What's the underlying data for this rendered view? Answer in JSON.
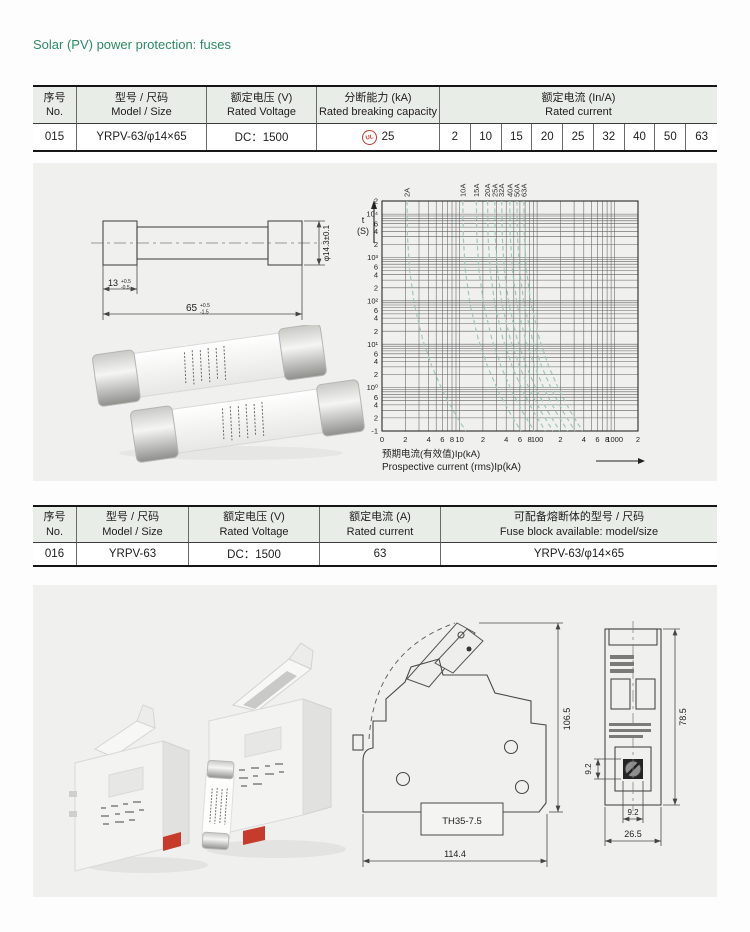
{
  "page": {
    "title": "Solar (PV) power protection: fuses"
  },
  "table1": {
    "headers": {
      "no_zh": "序号",
      "no_en": "No.",
      "model_zh": "型号 / 尺码",
      "model_en": "Model / Size",
      "voltage_zh": "额定电压 (V)",
      "voltage_en": "Rated Voltage",
      "breaking_zh": "分断能力 (kA)",
      "breaking_en": "Rated breaking capacity",
      "current_zh": "额定电流 (In/A)",
      "current_en": "Rated current"
    },
    "row": {
      "no": "015",
      "model": "YRPV-63/φ14×65",
      "voltage": "DC：1500",
      "breaking_mark": "UL",
      "breaking_value": "25",
      "currents": [
        "2",
        "10",
        "15",
        "20",
        "25",
        "32",
        "40",
        "50",
        "63"
      ]
    }
  },
  "fuse_drawing": {
    "dim_cap": "13",
    "dim_cap_tol_top": "+0.5",
    "dim_cap_tol_bottom": "-0.5",
    "dim_length": "65",
    "dim_length_tol_top": "+0.5",
    "dim_length_tol_bottom": "-1.5",
    "dim_diameter": "φ14.3±0.1"
  },
  "chart_data": {
    "type": "line",
    "title": "",
    "x_scale": "log",
    "y_scale": "log",
    "xlim": [
      1,
      2000
    ],
    "ylim": [
      0.1,
      20000
    ],
    "xlabel_zh": "预期电流(有效值)Ip(kA)",
    "xlabel_en": "Prospective current (rms)Ip(kA)",
    "ylabel_line1": "t",
    "ylabel_line2": "(S)",
    "grid": true,
    "legend_position": "top-rotated-labels",
    "curve_color": "#9ec9ba",
    "x_ticks": [
      {
        "v": 1,
        "label": "0"
      },
      {
        "v": 2,
        "label": "2"
      },
      {
        "v": 4,
        "label": "4"
      },
      {
        "v": 6,
        "label": "6"
      },
      {
        "v": 8,
        "label": "8"
      },
      {
        "v": 10,
        "label": "10"
      },
      {
        "v": 20,
        "label": "2"
      },
      {
        "v": 40,
        "label": "4"
      },
      {
        "v": 60,
        "label": "6"
      },
      {
        "v": 80,
        "label": "8"
      },
      {
        "v": 100,
        "label": "100"
      },
      {
        "v": 200,
        "label": "2"
      },
      {
        "v": 400,
        "label": "4"
      },
      {
        "v": 600,
        "label": "6"
      },
      {
        "v": 800,
        "label": "8"
      },
      {
        "v": 1000,
        "label": "1000"
      },
      {
        "v": 2000,
        "label": "2"
      }
    ],
    "y_ticks": [
      {
        "v": 20000,
        "label": "2"
      },
      {
        "v": 10000,
        "label": "10⁴"
      },
      {
        "v": 6000,
        "label": "6"
      },
      {
        "v": 4000,
        "label": "4"
      },
      {
        "v": 2000,
        "label": "2"
      },
      {
        "v": 1000,
        "label": "10³"
      },
      {
        "v": 600,
        "label": "6"
      },
      {
        "v": 400,
        "label": "4"
      },
      {
        "v": 200,
        "label": "2"
      },
      {
        "v": 100,
        "label": "10²"
      },
      {
        "v": 60,
        "label": "6"
      },
      {
        "v": 40,
        "label": "4"
      },
      {
        "v": 20,
        "label": "2"
      },
      {
        "v": 10,
        "label": "10¹"
      },
      {
        "v": 6,
        "label": "6"
      },
      {
        "v": 4,
        "label": "4"
      },
      {
        "v": 2,
        "label": "2"
      },
      {
        "v": 1,
        "label": "10⁰"
      },
      {
        "v": 0.6,
        "label": "6"
      },
      {
        "v": 0.4,
        "label": "4"
      },
      {
        "v": 0.2,
        "label": "2"
      },
      {
        "v": 0.1,
        "label": "-1"
      }
    ],
    "series": [
      {
        "name": "2A",
        "x_at_top": 2.1,
        "x_at_bottom": 12
      },
      {
        "name": "10A",
        "x_at_top": 11,
        "x_at_bottom": 62
      },
      {
        "name": "15A",
        "x_at_top": 16.5,
        "x_at_bottom": 92
      },
      {
        "name": "20A",
        "x_at_top": 23,
        "x_at_bottom": 128
      },
      {
        "name": "25A",
        "x_at_top": 28.5,
        "x_at_bottom": 160
      },
      {
        "name": "32A",
        "x_at_top": 35,
        "x_at_bottom": 196
      },
      {
        "name": "40A",
        "x_at_top": 44.5,
        "x_at_bottom": 248
      },
      {
        "name": "50A",
        "x_at_top": 55,
        "x_at_bottom": 308
      },
      {
        "name": "63A",
        "x_at_top": 67.5,
        "x_at_bottom": 385
      }
    ]
  },
  "table2": {
    "headers": {
      "no_zh": "序号",
      "no_en": "No.",
      "model_zh": "型号 / 尺码",
      "model_en": "Model / Size",
      "voltage_zh": "额定电压 (V)",
      "voltage_en": "Rated Voltage",
      "current_zh": "额定电流 (A)",
      "current_en": "Rated current",
      "block_zh": "可配备熔断体的型号 / 尺码",
      "block_en": "Fuse block available: model/size"
    },
    "row": {
      "no": "016",
      "model": "YRPV-63",
      "voltage": "DC：1500",
      "current": "63",
      "block": "YRPV-63/φ14×65"
    }
  },
  "side_drawing": {
    "dim_height": "106.5",
    "dim_rail": "TH35-7.5",
    "dim_width": "114.4"
  },
  "front_drawing": {
    "dim_height": "78.5",
    "dim_side": "9.2",
    "dim_screw": "9.2",
    "dim_width": "26.5"
  }
}
